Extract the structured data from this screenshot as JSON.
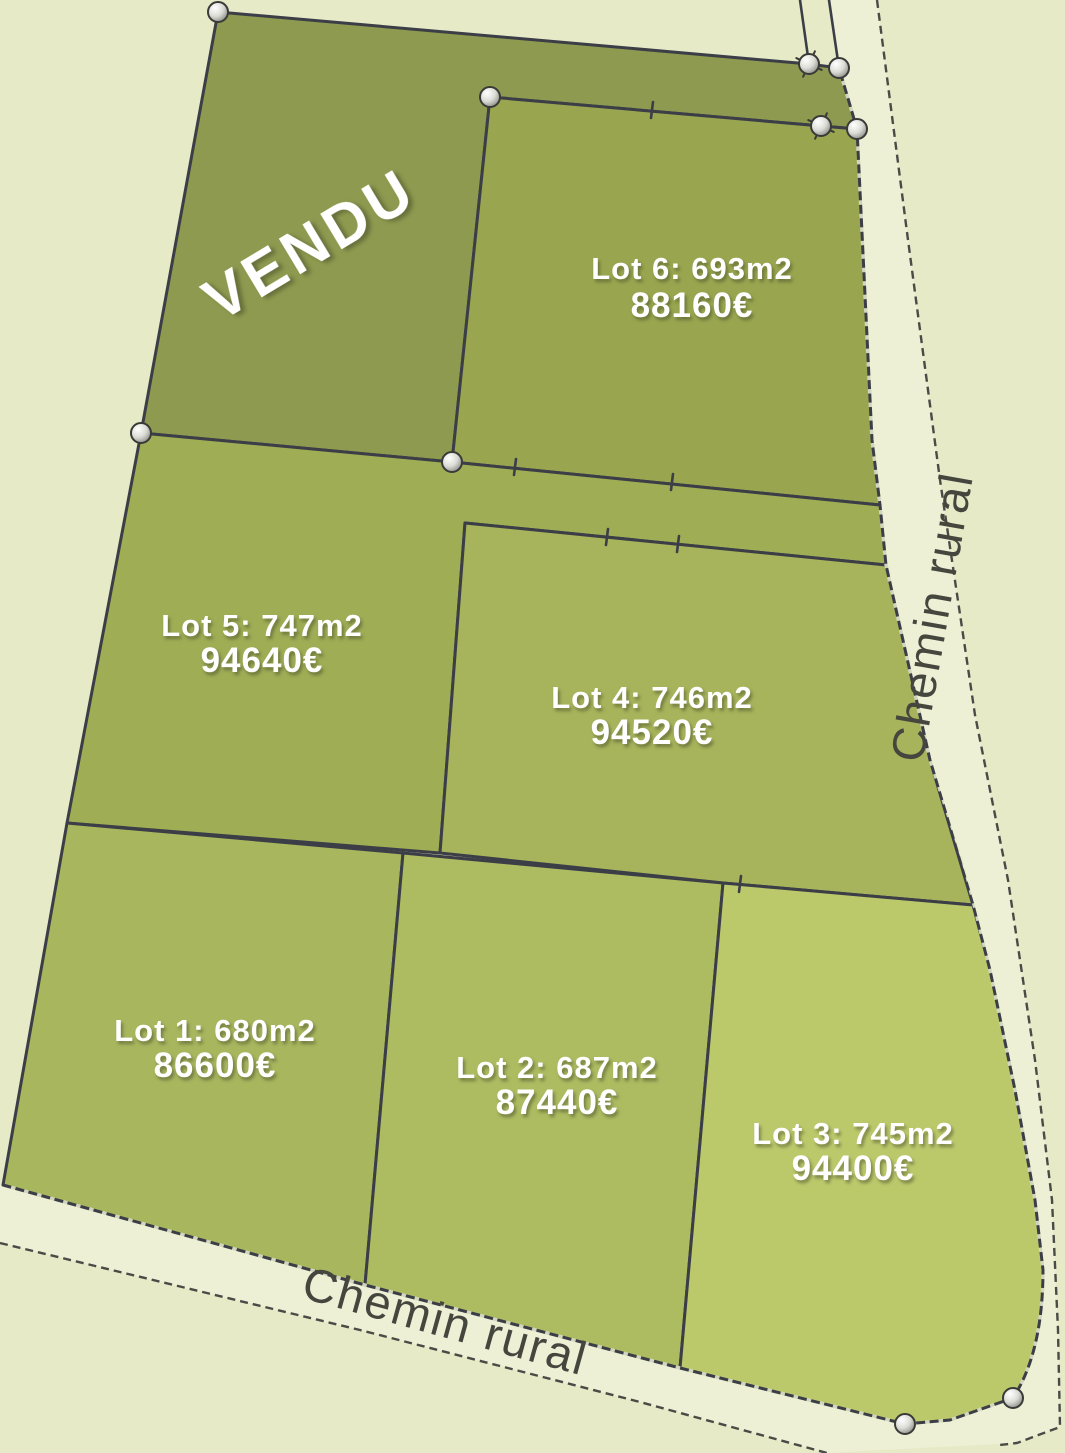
{
  "plan": {
    "type": "land-subdivision-sales-plan",
    "sold_stamp": "VENDU"
  },
  "palette": {
    "background": "#e7eac7",
    "road_surface": "#edf0d4",
    "boundary_line": "#3b3e47",
    "road_label_text": "#45463e",
    "label_text": "#ffffff",
    "sold_lot_fill": "#8d9a4f"
  },
  "roads": {
    "right": {
      "name": "Chemin rural"
    },
    "bottom": {
      "name": "Chemin rural"
    }
  },
  "sold": {
    "label": "VENDU",
    "color": "#8d9a4f"
  },
  "lots": [
    {
      "id": 1,
      "area_label": "Lot 1: 680m2",
      "price_label": "86600€",
      "area_m2": 680,
      "price_eur": 86600,
      "color": "#a8b65e"
    },
    {
      "id": 2,
      "area_label": "Lot 2: 687m2",
      "price_label": "87440€",
      "area_m2": 687,
      "price_eur": 87440,
      "color": "#adbb61"
    },
    {
      "id": 3,
      "area_label": "Lot 3: 745m2",
      "price_label": "94400€",
      "area_m2": 745,
      "price_eur": 94400,
      "color": "#bcc96b"
    },
    {
      "id": 4,
      "area_label": "Lot 4: 746m2",
      "price_label": "94520€",
      "area_m2": 746,
      "price_eur": 94520,
      "color": "#a7b45b"
    },
    {
      "id": 5,
      "area_label": "Lot 5: 747m2",
      "price_label": "94640€",
      "area_m2": 747,
      "price_eur": 94640,
      "color": "#9fad55"
    },
    {
      "id": 6,
      "area_label": "Lot 6: 693m2",
      "price_label": "88160€",
      "area_m2": 693,
      "price_eur": 88160,
      "color": "#99a64f"
    }
  ]
}
